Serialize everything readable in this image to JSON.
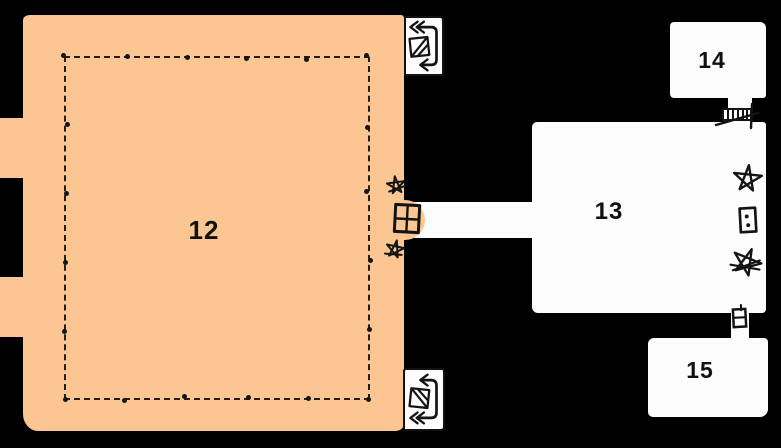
{
  "map": {
    "type": "hand-drawn dungeon floorplan",
    "colors": {
      "background": "#000000",
      "room12_fill": "#FBC691",
      "room_fill": "#FCFCFC",
      "ink": "#141414"
    },
    "rooms": [
      {
        "id": "room-12",
        "label": "12",
        "style": "tan room with dashed pillar-lined inner border, two west exits off map"
      },
      {
        "id": "room-13",
        "label": "13",
        "style": "white room east of room 12, connected by corridor"
      },
      {
        "id": "room-14",
        "label": "14",
        "style": "small white room north-east, door to room 13"
      },
      {
        "id": "room-15",
        "label": "15",
        "style": "small white room south-east, door to room 13"
      }
    ],
    "icons": [
      {
        "name": "spiral-stair-icon",
        "location": "north-east alcove of room 12"
      },
      {
        "name": "spiral-stair-icon",
        "location": "south-east alcove of room 12"
      },
      {
        "name": "four-pane-door-icon",
        "location": "east wall of room 12 at corridor to room 13"
      },
      {
        "name": "star-marker-icon",
        "location": "room 12 east wall, north of door"
      },
      {
        "name": "star-marker-icon",
        "location": "room 12 east wall, south of door"
      },
      {
        "name": "portcullis-door-icon",
        "location": "passage between room 13 and room 14"
      },
      {
        "name": "small-door-icon",
        "location": "passage between room 13 and room 15"
      },
      {
        "name": "pentagram-icon",
        "location": "east side of room 13, top"
      },
      {
        "name": "marked-door-icon",
        "location": "east side of room 13, middle"
      },
      {
        "name": "scribbled-pentagram-icon",
        "location": "east side of room 13, bottom"
      }
    ]
  }
}
